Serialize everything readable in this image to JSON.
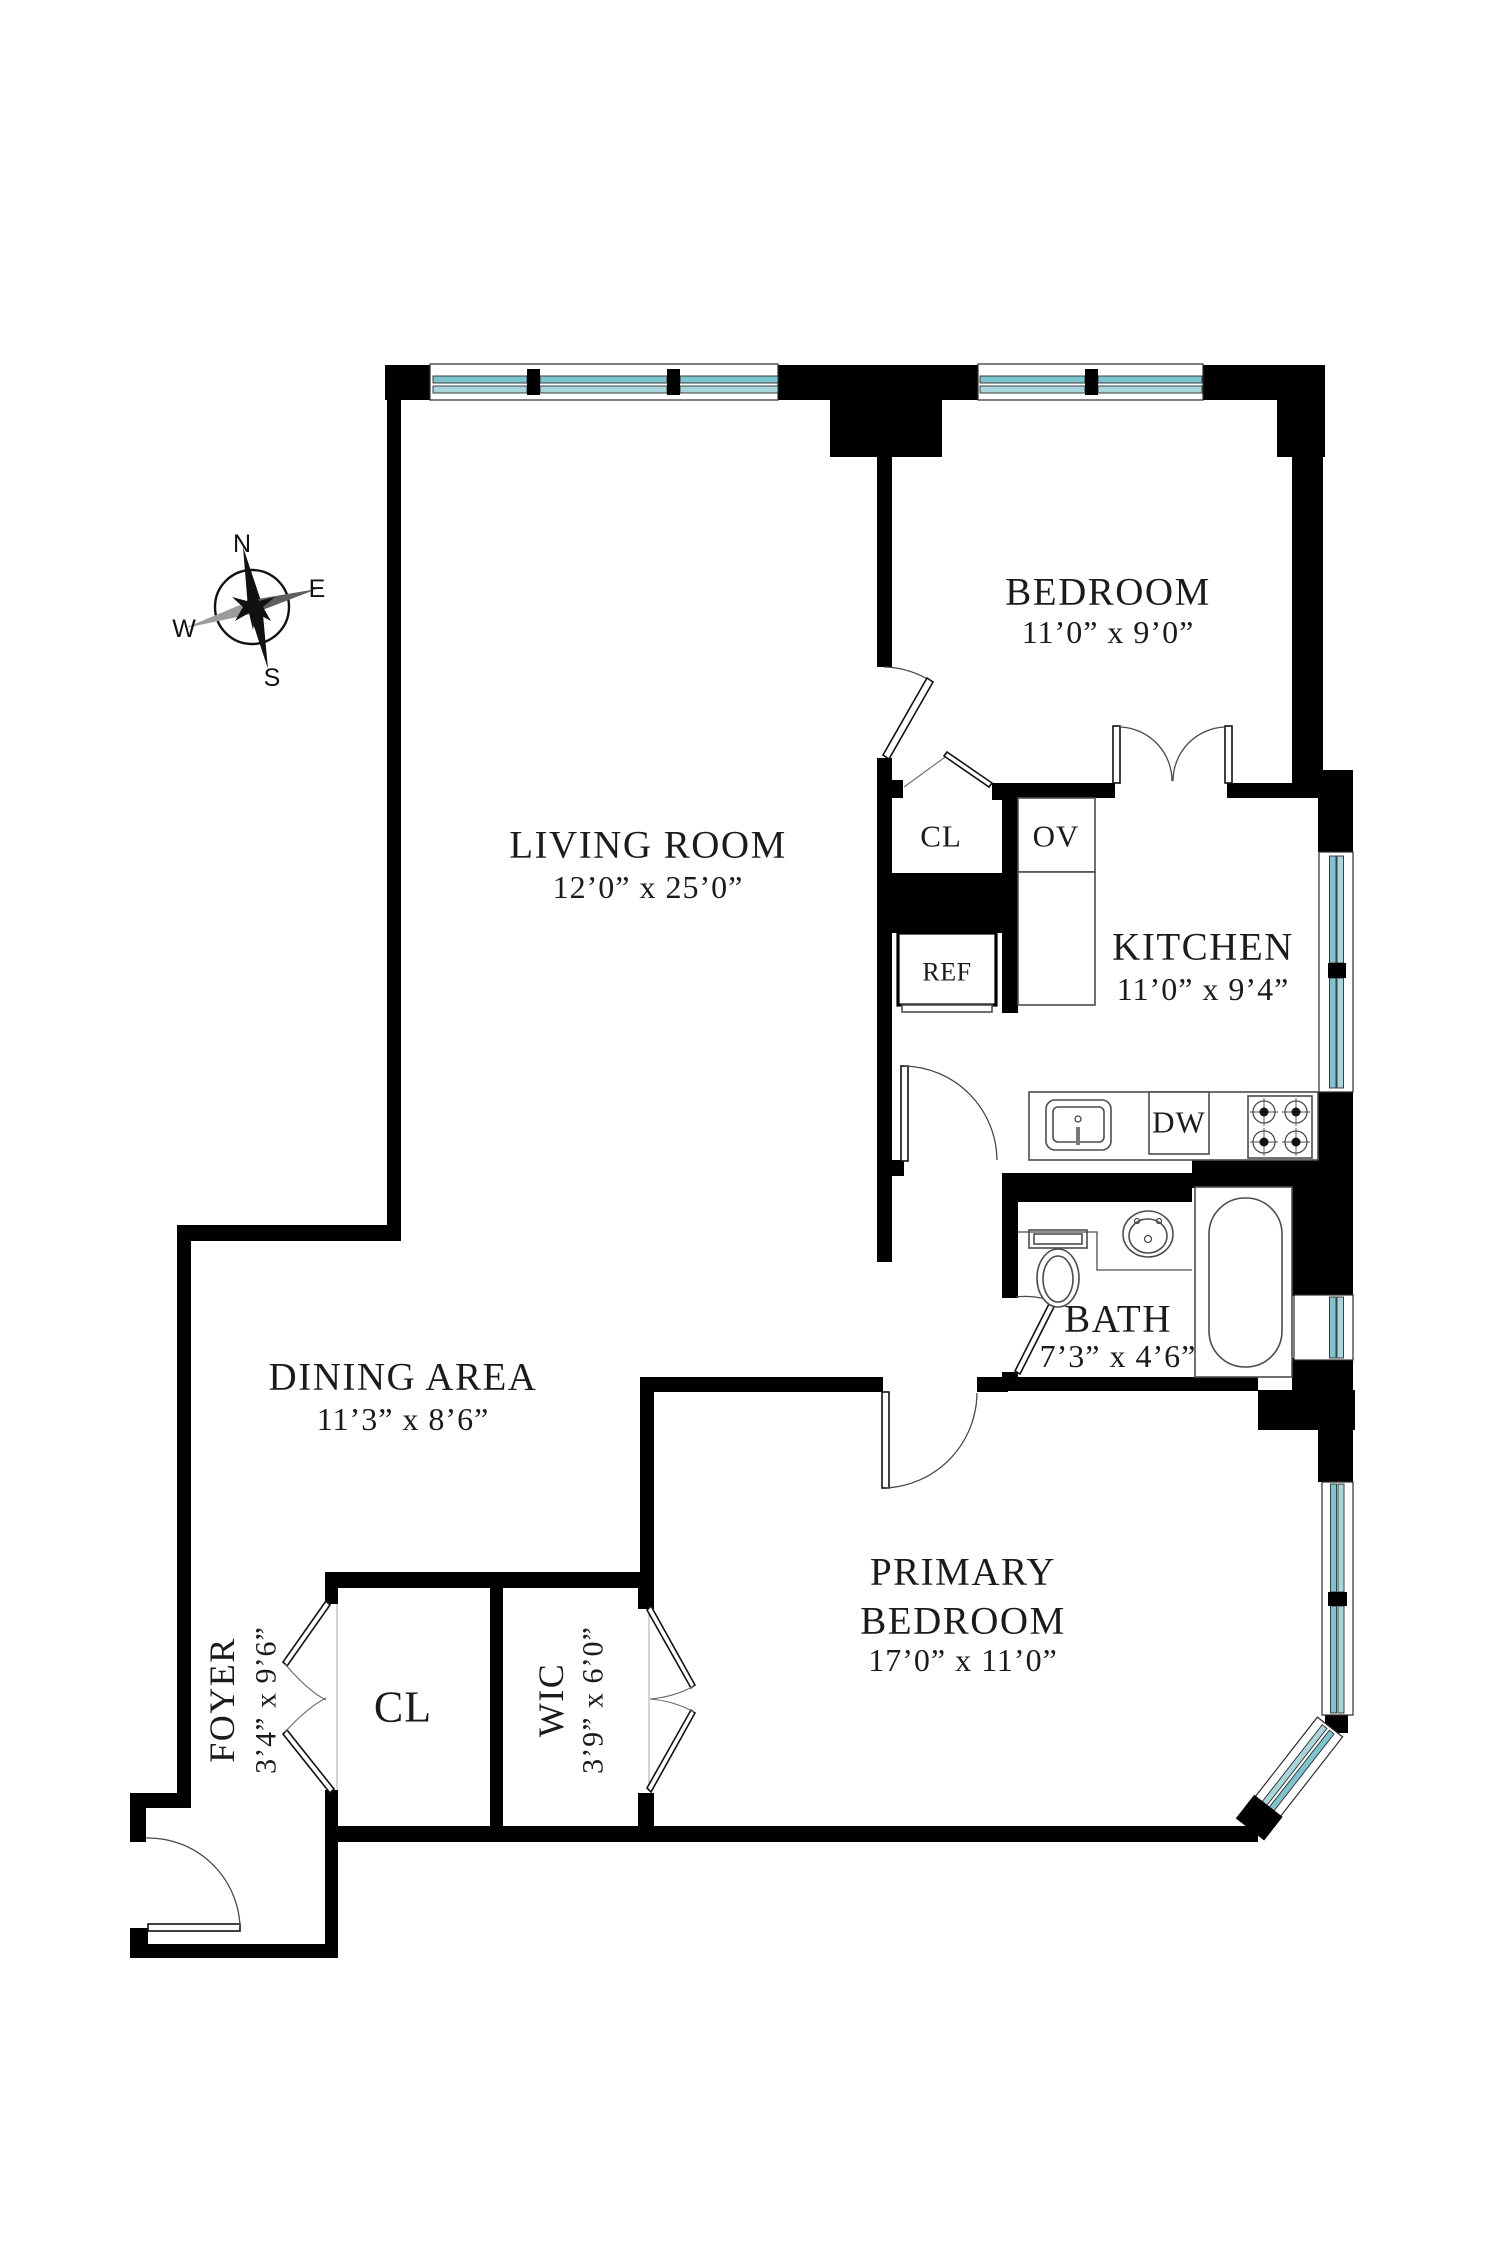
{
  "colors": {
    "wall": "#000000",
    "window_glass": "#7cc4ce",
    "window_glass_light": "#a7d6dc",
    "text": "#1b1b1b"
  },
  "compass": {
    "north": "N",
    "east": "E",
    "south": "S",
    "west": "W"
  },
  "rooms": {
    "living": {
      "name": "LIVING ROOM",
      "dims": "12’0” x 25’0”"
    },
    "bedroom": {
      "name": "BEDROOM",
      "dims": "11’0” x 9’0”"
    },
    "kitchen": {
      "name": "KITCHEN",
      "dims": "11’0” x 9’4”"
    },
    "bath": {
      "name": "BATH",
      "dims": "7’3” x 4’6”"
    },
    "dining": {
      "name": "DINING AREA",
      "dims": "11’3” x 8’6”"
    },
    "primary": {
      "name_line1": "PRIMARY",
      "name_line2": "BEDROOM",
      "dims": "17’0” x 11’0”"
    },
    "foyer": {
      "name": "FOYER",
      "dims": "3’4” x 9’6”"
    },
    "wic": {
      "name": "WIC",
      "dims": "3’9” x 6’0”"
    }
  },
  "fixtures": {
    "hall_closet": "CL",
    "foyer_closet": "CL",
    "oven": "OV",
    "refrigerator": "REF",
    "dishwasher": "DW"
  }
}
